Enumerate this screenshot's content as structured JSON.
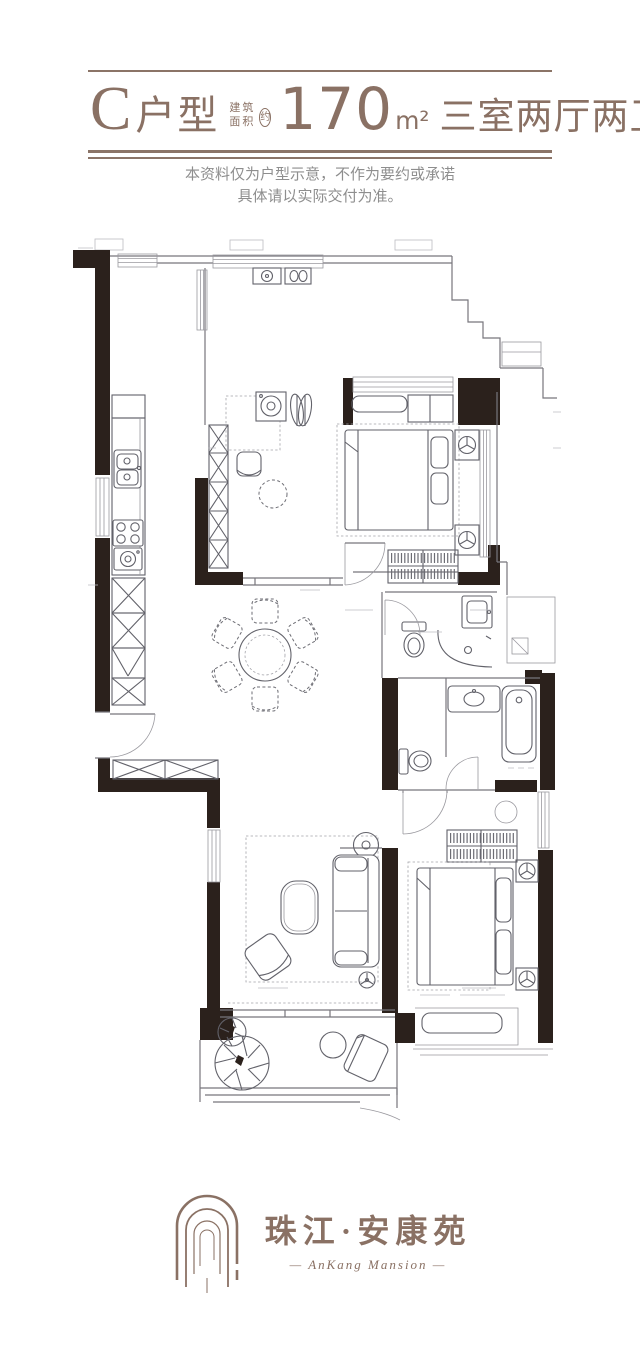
{
  "header": {
    "unit_label": "C",
    "unit_suffix": "户型",
    "area_prefix_line1": "建筑",
    "area_prefix_line2": "面积",
    "area_approx_badge": "约",
    "area_value": "170",
    "area_unit": "m²",
    "layout_summary": "三室两厅两卫",
    "accent_color": "#8a7164"
  },
  "disclaimer": {
    "line1": "本资料仅为户型示意，不作为要约或承诺",
    "line2": "具体请以实际交付为准。",
    "color": "#8e8e8e"
  },
  "floor_plan": {
    "wall_color": "#2b211c",
    "line_color": "#77767c",
    "elements": [
      "entry-door",
      "kitchen-sink",
      "kitchen-stove",
      "storage-cabinets",
      "dining-table-six-chairs",
      "laundry-machine",
      "study-desk",
      "bedroom-bed",
      "wardrobe-hangers",
      "nightstand-lamps",
      "guest-bathroom-toilet",
      "shower",
      "washbasin",
      "master-bathroom-bathtub",
      "living-sofa",
      "coffee-table",
      "armchair",
      "floor-lamp",
      "balcony-plant",
      "balcony-table",
      "balcony-chair",
      "bay-window-bench",
      "railing"
    ]
  },
  "logo": {
    "cn": "珠江·安康苑",
    "en": "— AnKang Mansion —",
    "color": "#8a7164"
  }
}
